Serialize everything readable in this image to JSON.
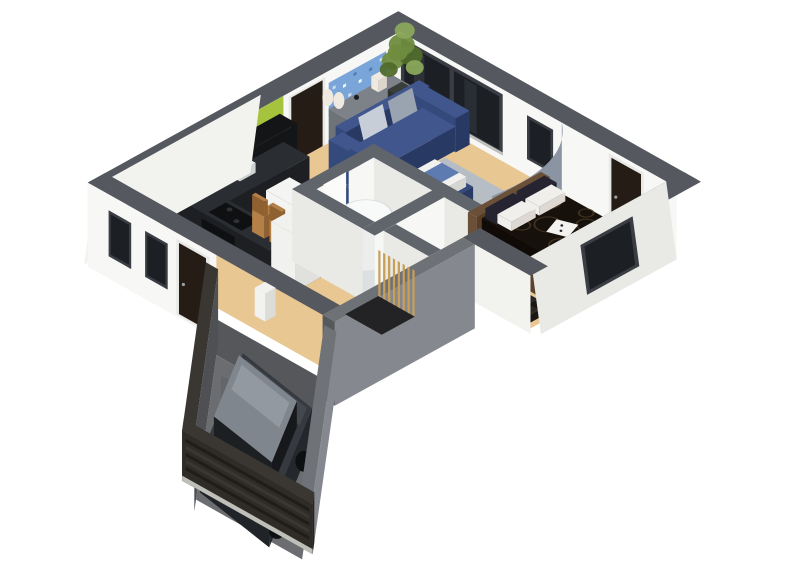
{
  "scene": {
    "background": "#ffffff",
    "aria_label": "3D isometric cutaway floor plan render of a single-storey house: kitchen with lime green accent wall, living room with navy sofas, bedroom with dark patterned bed, two bathrooms, hallway, and an attached garage containing a dark grey hatchback car behind a slatted garage door"
  },
  "rooms": [
    {
      "name": "kitchen",
      "floor": "dark slate tile",
      "features": [
        "lime green accent wall",
        "black gloss upper cabinets",
        "black countertop with cooktop and oven",
        "white breakfast bar",
        "wooden bar stools",
        "white fridge"
      ]
    },
    {
      "name": "living-room",
      "floor": "light oak wood",
      "features": [
        "navy three-seat sofa",
        "navy armchair",
        "navy loveseat",
        "navy ottoman table with white cushion",
        "grey rug",
        "grey sideboard",
        "blue abstract wall art",
        "potted plant",
        "floor lamp",
        "large dark sliding window"
      ]
    },
    {
      "name": "bedroom",
      "floor": "light oak wood",
      "features": [
        "double bed with dark patterned duvet",
        "wood headboard",
        "patterned pillows",
        "striped rug",
        "dark nightstand",
        "dark window",
        "dark door",
        "curved grey partition wall"
      ]
    },
    {
      "name": "bathrooms",
      "floor": "light grey tile",
      "features": [
        "round shower cabin",
        "white vanity sink",
        "white interior door"
      ]
    },
    {
      "name": "hallway",
      "floor": "light oak wood",
      "features": [
        "front door",
        "two dark front windows",
        "stair opening with wooden slat screen",
        "white pedestal"
      ]
    },
    {
      "name": "garage",
      "floor": "concrete",
      "features": [
        "dark grey hatchback car with red taillights",
        "slatted dark garage door",
        "dark concrete walls"
      ]
    }
  ],
  "colors": {
    "bg": "#ffffff",
    "capTop": "#55595f",
    "innerWallTop": "#60646b",
    "wallFace": "#f7f7f5",
    "wallFaceShade": "#e9e9e6",
    "wallOuter": "#f2f2ef",
    "windowGlass": "#1c1f24",
    "windowStreak": "#343a41",
    "frameDark": "#3a3e44",
    "sillLight": "#d8d8d4",
    "doorDark": "#241c15",
    "doorFrame": "#e8e8e6",
    "handle": "#9aa0a6",
    "greenAccent": "#a5c33d",
    "cabinet": "#141517",
    "cabinetGloss": "#303338",
    "counter": "#1d1f22",
    "counterTop": "#2a2d31",
    "ovenBlack": "#0f1012",
    "steel": "#8b8f94",
    "barWhite": "#f4f4f2",
    "barSide": "#e3e3e0",
    "stool": "#b48048",
    "stoolDark": "#8f6130",
    "fridge": "#f1f1ef",
    "fridgeSide": "#e0e0dd",
    "slate": "#4b5158",
    "slateLine": "#646b73",
    "woodFloor": "#e8c793",
    "woodLine": "#d2ab74",
    "bathFloor": "#dde0e2",
    "sideboard": "#6e7378",
    "sideboardTop": "#7d8289",
    "sideboardDark": "#5b6066",
    "lampShade": "#efe9e0",
    "lampPole": "#3c3f44",
    "artBlue": "#7aa5d8",
    "artLight": "#d6e4f4",
    "artDark": "#4a77b0",
    "plantGreen": "#6f8c3f",
    "plantDark": "#516b2c",
    "plantLight": "#8aa65a",
    "pot": "#2e312e",
    "sofa": "#344a7c",
    "sofaDark": "#283a64",
    "sofaTop": "#40568c",
    "cushion": "#9aa3b0",
    "cushionLight": "#c7ced7",
    "rug": "#b7bdc5",
    "rugEdge": "#a6acb5",
    "tableWhite": "#f1f1ef",
    "runnerBlue": "#5d7bb0",
    "curvedWall": "#8a94a3",
    "curvedTop": "#6b7585",
    "bedFrame": "#5a422e",
    "headboard": "#6b5038",
    "headboardDark": "#573d26",
    "duvet": "#17110c",
    "duvetSide": "#100b07",
    "swirl": "#4a3a24",
    "pillow": "#f1efec",
    "pillowPat": "#262430",
    "throwWhite": "#f4f2ee",
    "stripeA": "#d8cfbe",
    "stripeB": "#7c5e40",
    "stripeC": "#46372a",
    "stripeD": "#b2906a",
    "nightstand": "#23201c",
    "nightstandTop": "#2d2925",
    "showerWhite": "#eceeee",
    "showerTop": "#f8f9f9",
    "showerRim": "#d9dcdc",
    "sinkWhite": "#f6f6f4",
    "sinkShade": "#e0e0dd",
    "basin": "#b9bdc0",
    "concrete": "#6b6d71",
    "concreteDark": "#55575b",
    "concreteDeep": "#46484c",
    "garWall": "#3a3733",
    "garWallDark": "#2e2b27",
    "garDoor": "#2f2c28",
    "slatDark": "#1f1d1a",
    "slatLight": "#3a3732",
    "sill": "#cfcfca",
    "garWallLit": "#85888e",
    "garWallMid": "#6e7176",
    "garWallEnd": "#55585d",
    "carBody": "#363a40",
    "carSide": "#24272b",
    "carRear": "#202327",
    "carRoof": "#80868d",
    "roofStreak": "#9aa1a8",
    "hoodHi": "#454a50",
    "carWindow": "#16181b",
    "carRed": "#7e1d22",
    "carTrim": "#0e0f11",
    "seam": "#1b1d20",
    "slatWood": "#c79f58",
    "stepLine": "#4a4a4e",
    "pitDark": "#232325",
    "pedestal": "#f2f2f0"
  }
}
